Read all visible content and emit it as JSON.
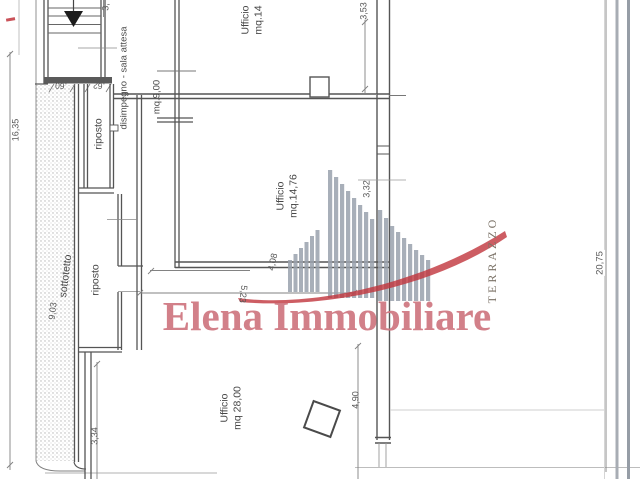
{
  "brand": {
    "watermark_text": "Elena Immobiliare"
  },
  "rooms": {
    "office_top": {
      "label": "Ufficio",
      "area": "mq.14"
    },
    "office_middle": {
      "label": "Ufficio",
      "area": "mq.14,76"
    },
    "office_bottom": {
      "label": "Ufficio",
      "area": "mq 28,00"
    },
    "hallway": {
      "label": "disimpegno - sala attesa",
      "area": "mq.9,00"
    },
    "storage_upper": {
      "label": "riposto"
    },
    "storage_lower": {
      "label": "riposto"
    },
    "attic": {
      "label": "sottotetto"
    },
    "terrace": {
      "label": "TERRAZZO"
    }
  },
  "dimensions": {
    "overall_left": "16,35",
    "attic_length": "9,03",
    "top_room_depth": "3,53",
    "top_partial": "3,",
    "door_a": ".60",
    "door_b": ".62",
    "middle_depth": "3,32",
    "middle_width_inner": "4,08",
    "middle_width_total": "5,23",
    "bottom_left_depth": "3,34",
    "bottom_depth": "4,90",
    "terrace_length": "20,75"
  },
  "colors": {
    "watermark": "#cf7680",
    "logo_red": "#c1343c",
    "logo_gray": "#9aa2ad",
    "line": "#555555"
  }
}
